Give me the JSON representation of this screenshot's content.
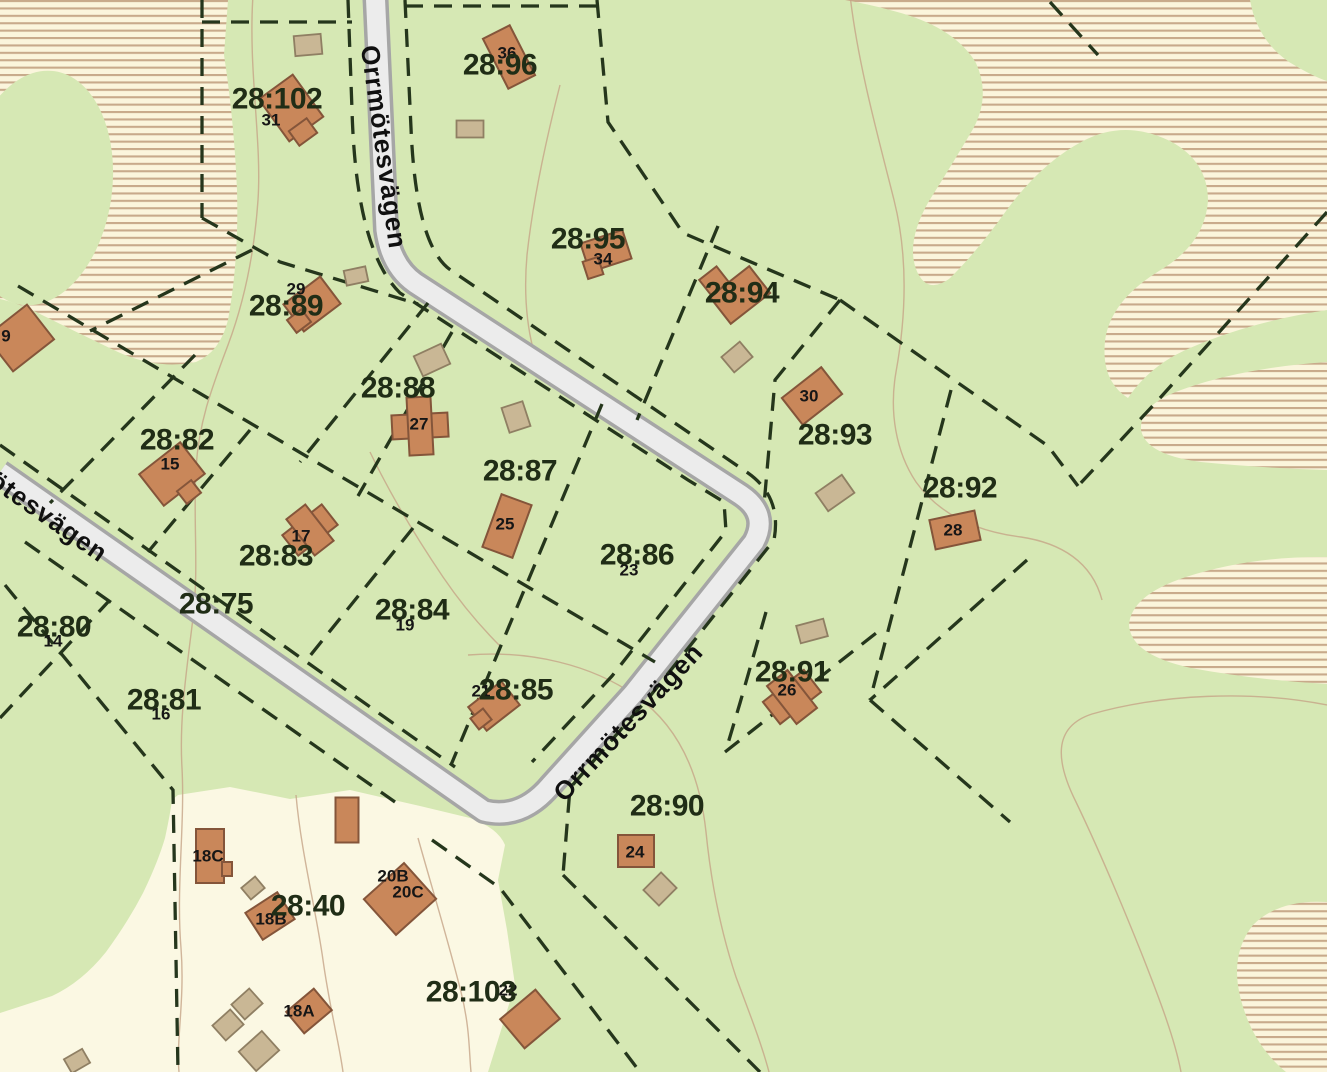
{
  "map": {
    "road_name": "Orrmötesvägen",
    "colors": {
      "ground_green": "#d6e8b4",
      "yard_cream": "#fbf8e3",
      "hatch_background": "#fbf5dc",
      "hatch_line": "#c8aa8b",
      "road_fill": "#ececec",
      "road_casing": "#a6a6a6",
      "boundary_dash": "#25361c",
      "building_fill": "#c9875a",
      "building_stroke": "#84553a",
      "shed_fill": "#c9b795",
      "contour_line": "#c5a487",
      "label_text": "#202d16"
    },
    "road_labels": [
      {
        "text": "Orrmötesvägen",
        "x": 384,
        "y": 147,
        "rot": 82
      },
      {
        "text": "Orrmötesvägen",
        "x": 628,
        "y": 722,
        "rot": -47
      },
      {
        "text": "Orrmötesvägen",
        "x": 21,
        "y": 497,
        "rot": 35
      }
    ],
    "parcel_labels": [
      {
        "text": "28:102",
        "x": 277,
        "y": 99
      },
      {
        "text": "28:96",
        "x": 500,
        "y": 65
      },
      {
        "text": "28:95",
        "x": 588,
        "y": 239
      },
      {
        "text": "28:94",
        "x": 742,
        "y": 293
      },
      {
        "text": "28:89",
        "x": 286,
        "y": 306
      },
      {
        "text": "28:88",
        "x": 398,
        "y": 388
      },
      {
        "text": "28:87",
        "x": 520,
        "y": 471
      },
      {
        "text": "28:86",
        "x": 637,
        "y": 555
      },
      {
        "text": "28:82",
        "x": 177,
        "y": 440
      },
      {
        "text": "28:83",
        "x": 276,
        "y": 556
      },
      {
        "text": "28:84",
        "x": 412,
        "y": 610
      },
      {
        "text": "28:85",
        "x": 516,
        "y": 690
      },
      {
        "text": "28:75",
        "x": 216,
        "y": 604
      },
      {
        "text": "28:80",
        "x": 54,
        "y": 627
      },
      {
        "text": "28:81",
        "x": 164,
        "y": 700
      },
      {
        "text": "28:93",
        "x": 835,
        "y": 435
      },
      {
        "text": "28:92",
        "x": 960,
        "y": 488
      },
      {
        "text": "28:91",
        "x": 792,
        "y": 672
      },
      {
        "text": "28:90",
        "x": 667,
        "y": 806
      },
      {
        "text": "28:40",
        "x": 308,
        "y": 906
      },
      {
        "text": "28:103",
        "x": 471,
        "y": 992
      }
    ],
    "address_numbers": [
      {
        "text": "31",
        "x": 271,
        "y": 120
      },
      {
        "text": "36",
        "x": 507,
        "y": 53
      },
      {
        "text": "34",
        "x": 603,
        "y": 259
      },
      {
        "text": "29",
        "x": 296,
        "y": 289
      },
      {
        "text": "27",
        "x": 419,
        "y": 424
      },
      {
        "text": "25",
        "x": 505,
        "y": 524
      },
      {
        "text": "23",
        "x": 629,
        "y": 570
      },
      {
        "text": "15",
        "x": 170,
        "y": 464
      },
      {
        "text": "17",
        "x": 301,
        "y": 536
      },
      {
        "text": "19",
        "x": 405,
        "y": 625
      },
      {
        "text": "14",
        "x": 53,
        "y": 641
      },
      {
        "text": "16",
        "x": 161,
        "y": 714
      },
      {
        "text": "21",
        "x": 481,
        "y": 691
      },
      {
        "text": "30",
        "x": 809,
        "y": 396
      },
      {
        "text": "28",
        "x": 953,
        "y": 530
      },
      {
        "text": "26",
        "x": 787,
        "y": 690
      },
      {
        "text": "24",
        "x": 635,
        "y": 852
      },
      {
        "text": "22",
        "x": 508,
        "y": 990
      },
      {
        "text": "18C",
        "x": 208,
        "y": 856
      },
      {
        "text": "18B",
        "x": 271,
        "y": 919
      },
      {
        "text": "20B",
        "x": 393,
        "y": 876
      },
      {
        "text": "20C",
        "x": 408,
        "y": 892
      },
      {
        "text": "18A",
        "x": 299,
        "y": 1011
      },
      {
        "text": "9",
        "x": 6,
        "y": 336
      }
    ],
    "buildings": [
      {
        "x": 291,
        "y": 108,
        "w": 42,
        "h": 52,
        "r": -36
      },
      {
        "x": 303,
        "y": 132,
        "w": 22,
        "h": 18,
        "r": -36
      },
      {
        "x": 509,
        "y": 57,
        "w": 30,
        "h": 56,
        "r": -27
      },
      {
        "x": 606,
        "y": 251,
        "w": 44,
        "h": 30,
        "r": -18
      },
      {
        "x": 593,
        "y": 268,
        "w": 16,
        "h": 18,
        "r": -18
      },
      {
        "x": 740,
        "y": 295,
        "w": 50,
        "h": 34,
        "r": -38
      },
      {
        "x": 714,
        "y": 281,
        "w": 22,
        "h": 20,
        "r": -38
      },
      {
        "x": 312,
        "y": 304,
        "w": 46,
        "h": 34,
        "r": -37
      },
      {
        "x": 299,
        "y": 321,
        "w": 18,
        "h": 16,
        "r": -37
      },
      {
        "x": 420,
        "y": 426,
        "w": 56,
        "h": 24,
        "r": -3
      },
      {
        "x": 420,
        "y": 426,
        "w": 24,
        "h": 58,
        "r": -3
      },
      {
        "x": 507,
        "y": 526,
        "w": 32,
        "h": 56,
        "r": 20
      },
      {
        "x": 172,
        "y": 474,
        "w": 52,
        "h": 40,
        "r": -38
      },
      {
        "x": 189,
        "y": 492,
        "w": 18,
        "h": 16,
        "r": -38
      },
      {
        "x": 310,
        "y": 530,
        "w": 50,
        "h": 26,
        "r": -38
      },
      {
        "x": 310,
        "y": 530,
        "w": 24,
        "h": 46,
        "r": -38
      },
      {
        "x": 494,
        "y": 706,
        "w": 42,
        "h": 30,
        "r": -38
      },
      {
        "x": 481,
        "y": 719,
        "w": 16,
        "h": 14,
        "r": -38
      },
      {
        "x": 792,
        "y": 697,
        "w": 52,
        "h": 28,
        "r": -38
      },
      {
        "x": 792,
        "y": 697,
        "w": 26,
        "h": 48,
        "r": -38
      },
      {
        "x": 812,
        "y": 396,
        "w": 50,
        "h": 34,
        "r": -38
      },
      {
        "x": 955,
        "y": 530,
        "w": 46,
        "h": 30,
        "r": -12
      },
      {
        "x": 636,
        "y": 851,
        "w": 36,
        "h": 32,
        "r": 0
      },
      {
        "x": 530,
        "y": 1019,
        "w": 46,
        "h": 38,
        "r": -40
      },
      {
        "x": 210,
        "y": 856,
        "w": 28,
        "h": 54,
        "r": 0
      },
      {
        "x": 227,
        "y": 869,
        "w": 10,
        "h": 14,
        "r": 0
      },
      {
        "x": 270,
        "y": 916,
        "w": 38,
        "h": 32,
        "r": -33
      },
      {
        "x": 400,
        "y": 899,
        "w": 54,
        "h": 48,
        "r": -42
      },
      {
        "x": 309,
        "y": 1011,
        "w": 36,
        "h": 28,
        "r": -40
      },
      {
        "x": 347,
        "y": 820,
        "w": 23,
        "h": 45,
        "r": 0
      },
      {
        "x": 20,
        "y": 338,
        "w": 52,
        "h": 44,
        "r": -38
      }
    ],
    "sheds": [
      {
        "x": 308,
        "y": 45,
        "w": 27,
        "h": 20,
        "r": -5
      },
      {
        "x": 470,
        "y": 129,
        "w": 27,
        "h": 17,
        "r": 0
      },
      {
        "x": 356,
        "y": 276,
        "w": 22,
        "h": 15,
        "r": -12
      },
      {
        "x": 432,
        "y": 360,
        "w": 30,
        "h": 22,
        "r": -25
      },
      {
        "x": 516,
        "y": 417,
        "w": 22,
        "h": 26,
        "r": -18
      },
      {
        "x": 737,
        "y": 357,
        "w": 24,
        "h": 20,
        "r": -40
      },
      {
        "x": 835,
        "y": 493,
        "w": 32,
        "h": 22,
        "r": -35
      },
      {
        "x": 812,
        "y": 631,
        "w": 28,
        "h": 18,
        "r": -15
      },
      {
        "x": 660,
        "y": 889,
        "w": 25,
        "h": 22,
        "r": -45
      },
      {
        "x": 253,
        "y": 888,
        "w": 18,
        "h": 15,
        "r": -40
      },
      {
        "x": 247,
        "y": 1004,
        "w": 24,
        "h": 20,
        "r": -42
      },
      {
        "x": 228,
        "y": 1025,
        "w": 24,
        "h": 20,
        "r": -42
      },
      {
        "x": 259,
        "y": 1051,
        "w": 31,
        "h": 26,
        "r": -42
      },
      {
        "x": 77,
        "y": 1061,
        "w": 21,
        "h": 16,
        "r": -30
      }
    ]
  }
}
